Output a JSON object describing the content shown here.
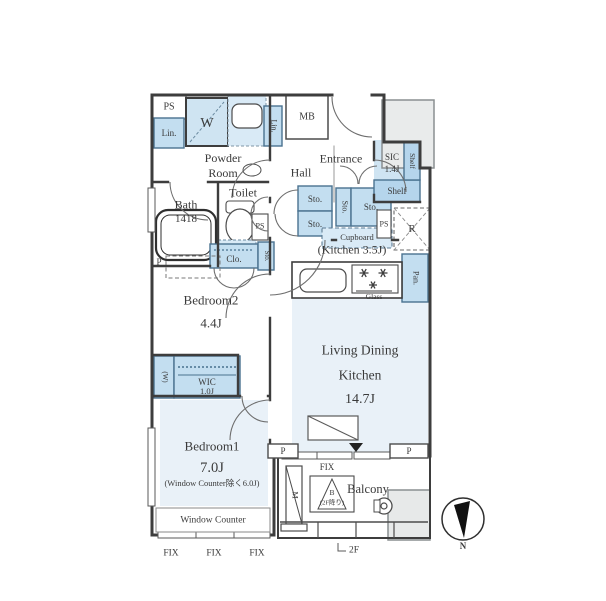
{
  "floor_plan": {
    "rooms": {
      "powder_room": {
        "line1": "Powder",
        "line2": "Room"
      },
      "hall": {
        "label": "Hall"
      },
      "entrance": {
        "label": "Entrance"
      },
      "sic": {
        "label": "SIC",
        "size": "1.4J"
      },
      "bath": {
        "label": "Bath",
        "size": "1418"
      },
      "toilet": {
        "label": "Toilet"
      },
      "kitchen": {
        "label": "(Kitchen 3.5J)"
      },
      "ldk": {
        "line1": "Living Dining",
        "line2": "Kitchen",
        "size": "14.7J"
      },
      "bedroom2": {
        "label": "Bedroom2",
        "size": "4.4J"
      },
      "wic": {
        "label": "WIC",
        "size": "1.0J"
      },
      "bedroom1": {
        "label": "Bedroom1",
        "size": "7.0J",
        "note": "(Window Counter除く6.0J)"
      },
      "window_counter": {
        "label": "Window Counter"
      },
      "balcony": {
        "label": "Balcony"
      }
    },
    "fixtures": {
      "ps_top": "PS",
      "ps_toilet": "PS",
      "ps_kitchen": "PS",
      "linen_top": "Lin.",
      "linen_side": "Lin.",
      "washer": "W",
      "meter_box": "MB",
      "shelf_side": "Shelf",
      "shelf_bottom": "Shelf",
      "storage_hall_upper": "Sto.",
      "storage_hall_lower": "Sto.",
      "storage_entrance_side": "Sto.",
      "storage_entrance": "Sto.",
      "storage_closet_side": "Sto.",
      "closet": "Clo.",
      "cupboard": "Cupboard",
      "refrigerator": "R",
      "pantry": "Pan.",
      "stove_glass": "Glass",
      "wic_washer": "(W)",
      "balcony_partition": "M",
      "hatch_label": "B",
      "hatch_note": "(2F降り)",
      "pillar": "P"
    },
    "annotations": {
      "fix_window_ldk": "FIX",
      "fix_windows_bottom": [
        "FIX",
        "FIX",
        "FIX"
      ],
      "floor_note": "2F",
      "compass_north": "N"
    },
    "colors": {
      "wall": "#3d3d3d",
      "room_fill": "#e9f1f8",
      "fixture_fill": "#c3def0",
      "fixture_mid": "#d9eaf6",
      "gray_fill": "#e9ebeb"
    }
  }
}
